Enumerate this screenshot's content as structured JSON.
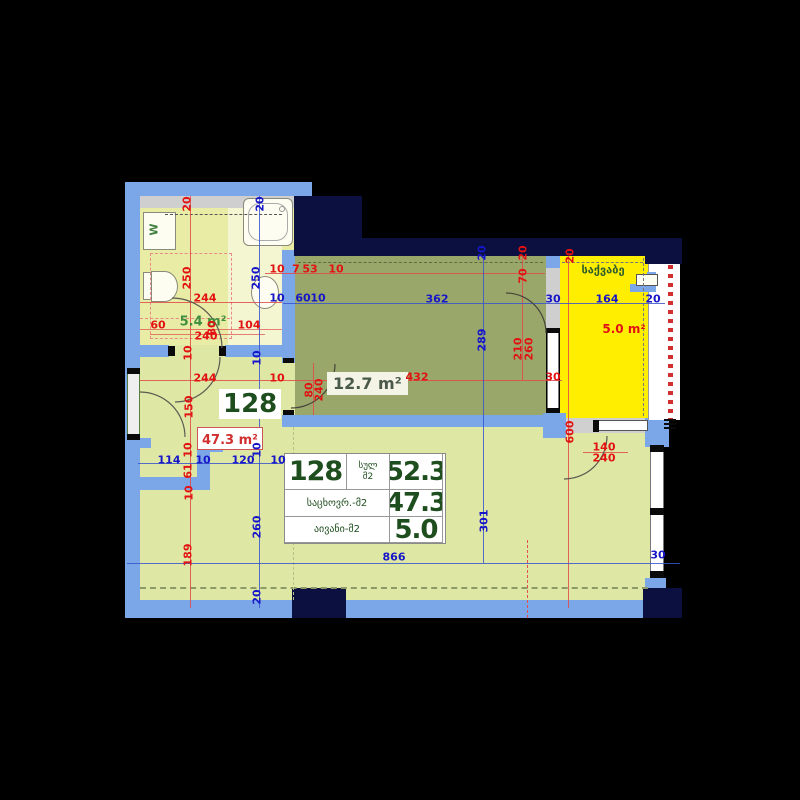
{
  "title": "Apartment 128 floor plan",
  "unit": {
    "number": "128",
    "total_label": "სულ\nმ2",
    "total_value": "52.3",
    "living_label": "საცხოვრ.-მ2",
    "living_value": "47.3",
    "balcony_label": "აივანი-მ2",
    "balcony_value": "5.0"
  },
  "rooms": {
    "bathroom": {
      "area": "5.4 m²"
    },
    "bedroom": {
      "area": "12.7 m²"
    },
    "living": {
      "area": "47.3 m²",
      "number": "128"
    },
    "boiler": {
      "name": "საქვაბე",
      "area": "5.0 m²"
    },
    "washer_label": "W"
  },
  "colors": {
    "wall": "#7ba7e8",
    "structure": "#0b1040",
    "bathroom_floor": "#e9eca4",
    "living_floor": "#dfe7a4",
    "bedroom_floor": "#99a76a",
    "balcony_floor": "#ffee00",
    "dim_red": "#e31212",
    "dim_blue": "#1616c8",
    "label_green": "#1e4d1e"
  },
  "dimensions": [
    {
      "t": "20",
      "x": 187,
      "y": 204,
      "c": "r",
      "rot": 1
    },
    {
      "t": "20",
      "x": 260,
      "y": 204,
      "c": "b",
      "rot": 1
    },
    {
      "t": "250",
      "x": 187,
      "y": 278,
      "c": "r",
      "rot": 1
    },
    {
      "t": "250",
      "x": 256,
      "y": 278,
      "c": "b",
      "rot": 1
    },
    {
      "t": "10",
      "x": 277,
      "y": 269,
      "c": "r"
    },
    {
      "t": "7",
      "x": 296,
      "y": 269,
      "c": "r"
    },
    {
      "t": "53",
      "x": 310,
      "y": 269,
      "c": "r"
    },
    {
      "t": "10",
      "x": 336,
      "y": 269,
      "c": "r"
    },
    {
      "t": "244",
      "x": 205,
      "y": 298,
      "c": "r"
    },
    {
      "t": "10",
      "x": 277,
      "y": 298,
      "c": "b"
    },
    {
      "t": "60",
      "x": 303,
      "y": 298,
      "c": "b"
    },
    {
      "t": "10",
      "x": 318,
      "y": 298,
      "c": "b"
    },
    {
      "t": "362",
      "x": 437,
      "y": 299,
      "c": "b"
    },
    {
      "t": "30",
      "x": 553,
      "y": 299,
      "c": "b"
    },
    {
      "t": "164",
      "x": 607,
      "y": 299,
      "c": "b"
    },
    {
      "t": "20",
      "x": 653,
      "y": 299,
      "c": "b"
    },
    {
      "t": "60",
      "x": 158,
      "y": 325,
      "c": "r"
    },
    {
      "t": "104",
      "x": 249,
      "y": 325,
      "c": "r"
    },
    {
      "t": "80",
      "x": 212,
      "y": 328,
      "c": "r",
      "rot": 1
    },
    {
      "t": "240",
      "x": 206,
      "y": 336,
      "c": "r"
    },
    {
      "t": "20",
      "x": 482,
      "y": 253,
      "c": "b",
      "rot": 1
    },
    {
      "t": "20",
      "x": 523,
      "y": 253,
      "c": "r",
      "rot": 1
    },
    {
      "t": "70",
      "x": 523,
      "y": 276,
      "c": "r",
      "rot": 1
    },
    {
      "t": "20",
      "x": 570,
      "y": 256,
      "c": "r",
      "rot": 1
    },
    {
      "t": "10",
      "x": 188,
      "y": 353,
      "c": "r",
      "rot": 1
    },
    {
      "t": "10",
      "x": 257,
      "y": 358,
      "c": "b",
      "rot": 1
    },
    {
      "t": "244",
      "x": 205,
      "y": 378,
      "c": "r"
    },
    {
      "t": "10",
      "x": 277,
      "y": 378,
      "c": "r"
    },
    {
      "t": "432",
      "x": 417,
      "y": 377,
      "c": "r"
    },
    {
      "t": "289",
      "x": 482,
      "y": 340,
      "c": "b",
      "rot": 1
    },
    {
      "t": "210",
      "x": 518,
      "y": 349,
      "c": "r",
      "rot": 1
    },
    {
      "t": "260",
      "x": 529,
      "y": 349,
      "c": "r",
      "rot": 1
    },
    {
      "t": "30",
      "x": 553,
      "y": 377,
      "c": "r"
    },
    {
      "t": "80",
      "x": 309,
      "y": 390,
      "c": "r",
      "rot": 1
    },
    {
      "t": "240",
      "x": 319,
      "y": 390,
      "c": "r",
      "rot": 1
    },
    {
      "t": "150",
      "x": 189,
      "y": 407,
      "c": "r",
      "rot": 1
    },
    {
      "t": "600",
      "x": 570,
      "y": 432,
      "c": "r",
      "rot": 1
    },
    {
      "t": "140",
      "x": 604,
      "y": 447,
      "c": "r"
    },
    {
      "t": "240",
      "x": 604,
      "y": 458,
      "c": "r"
    },
    {
      "t": "10",
      "x": 188,
      "y": 450,
      "c": "r",
      "rot": 1
    },
    {
      "t": "10",
      "x": 257,
      "y": 450,
      "c": "b",
      "rot": 1
    },
    {
      "t": "114",
      "x": 169,
      "y": 460,
      "c": "b"
    },
    {
      "t": "10",
      "x": 203,
      "y": 460,
      "c": "b"
    },
    {
      "t": "120",
      "x": 243,
      "y": 460,
      "c": "b"
    },
    {
      "t": "10",
      "x": 278,
      "y": 460,
      "c": "b"
    },
    {
      "t": "61",
      "x": 188,
      "y": 471,
      "c": "r",
      "rot": 1
    },
    {
      "t": "10",
      "x": 189,
      "y": 493,
      "c": "r",
      "rot": 1
    },
    {
      "t": "260",
      "x": 257,
      "y": 527,
      "c": "b",
      "rot": 1
    },
    {
      "t": "301",
      "x": 484,
      "y": 521,
      "c": "b",
      "rot": 1
    },
    {
      "t": "189",
      "x": 188,
      "y": 555,
      "c": "r",
      "rot": 1
    },
    {
      "t": "866",
      "x": 394,
      "y": 557,
      "c": "b"
    },
    {
      "t": "30",
      "x": 658,
      "y": 555,
      "c": "b"
    },
    {
      "t": "20",
      "x": 257,
      "y": 597,
      "c": "b",
      "rot": 1
    }
  ]
}
